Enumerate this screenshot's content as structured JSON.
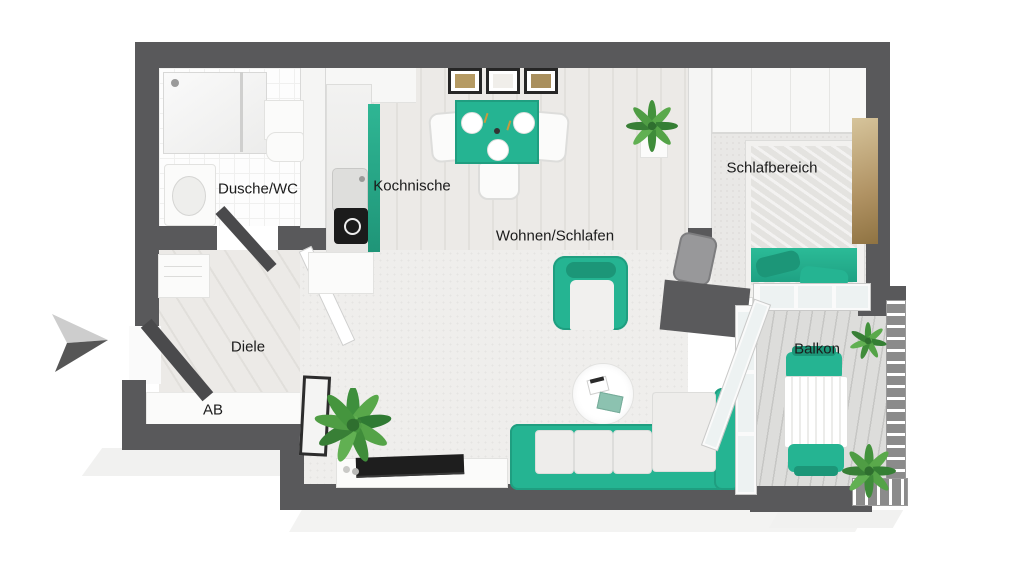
{
  "plan": {
    "type": "3d-floor-plan-top-view",
    "language": "de",
    "rooms": [
      {
        "id": "dusche-wc",
        "label": "Dusche/WC"
      },
      {
        "id": "kochnische",
        "label": "Kochnische"
      },
      {
        "id": "wohnen-schlafen",
        "label": "Wohnen/Schlafen"
      },
      {
        "id": "schlafbereich",
        "label": "Schlafbereich"
      },
      {
        "id": "diele",
        "label": "Diele"
      },
      {
        "id": "ab",
        "label": "AB"
      },
      {
        "id": "balkon",
        "label": "Balkon"
      }
    ],
    "colors": {
      "wall": "#59595b",
      "accent_teal": "#25b492",
      "accent_teal_dark": "#1c9678",
      "floor_wood": "#eceae7",
      "floor_carpet": "#efeeec",
      "balcony_deck": "#d7d7d5",
      "label_text": "#1b1b1b",
      "plant_green": "#43923c"
    },
    "icons": [
      {
        "name": "entrance-arrow-icon"
      }
    ]
  },
  "rooms": [
    {
      "label": "Dusche/WC"
    },
    {
      "label": "Kochnische"
    },
    {
      "label": "Wohnen/Schlafen"
    },
    {
      "label": "Schlafbereich"
    },
    {
      "label": "Diele"
    },
    {
      "label": "AB"
    },
    {
      "label": "Balkon"
    }
  ]
}
